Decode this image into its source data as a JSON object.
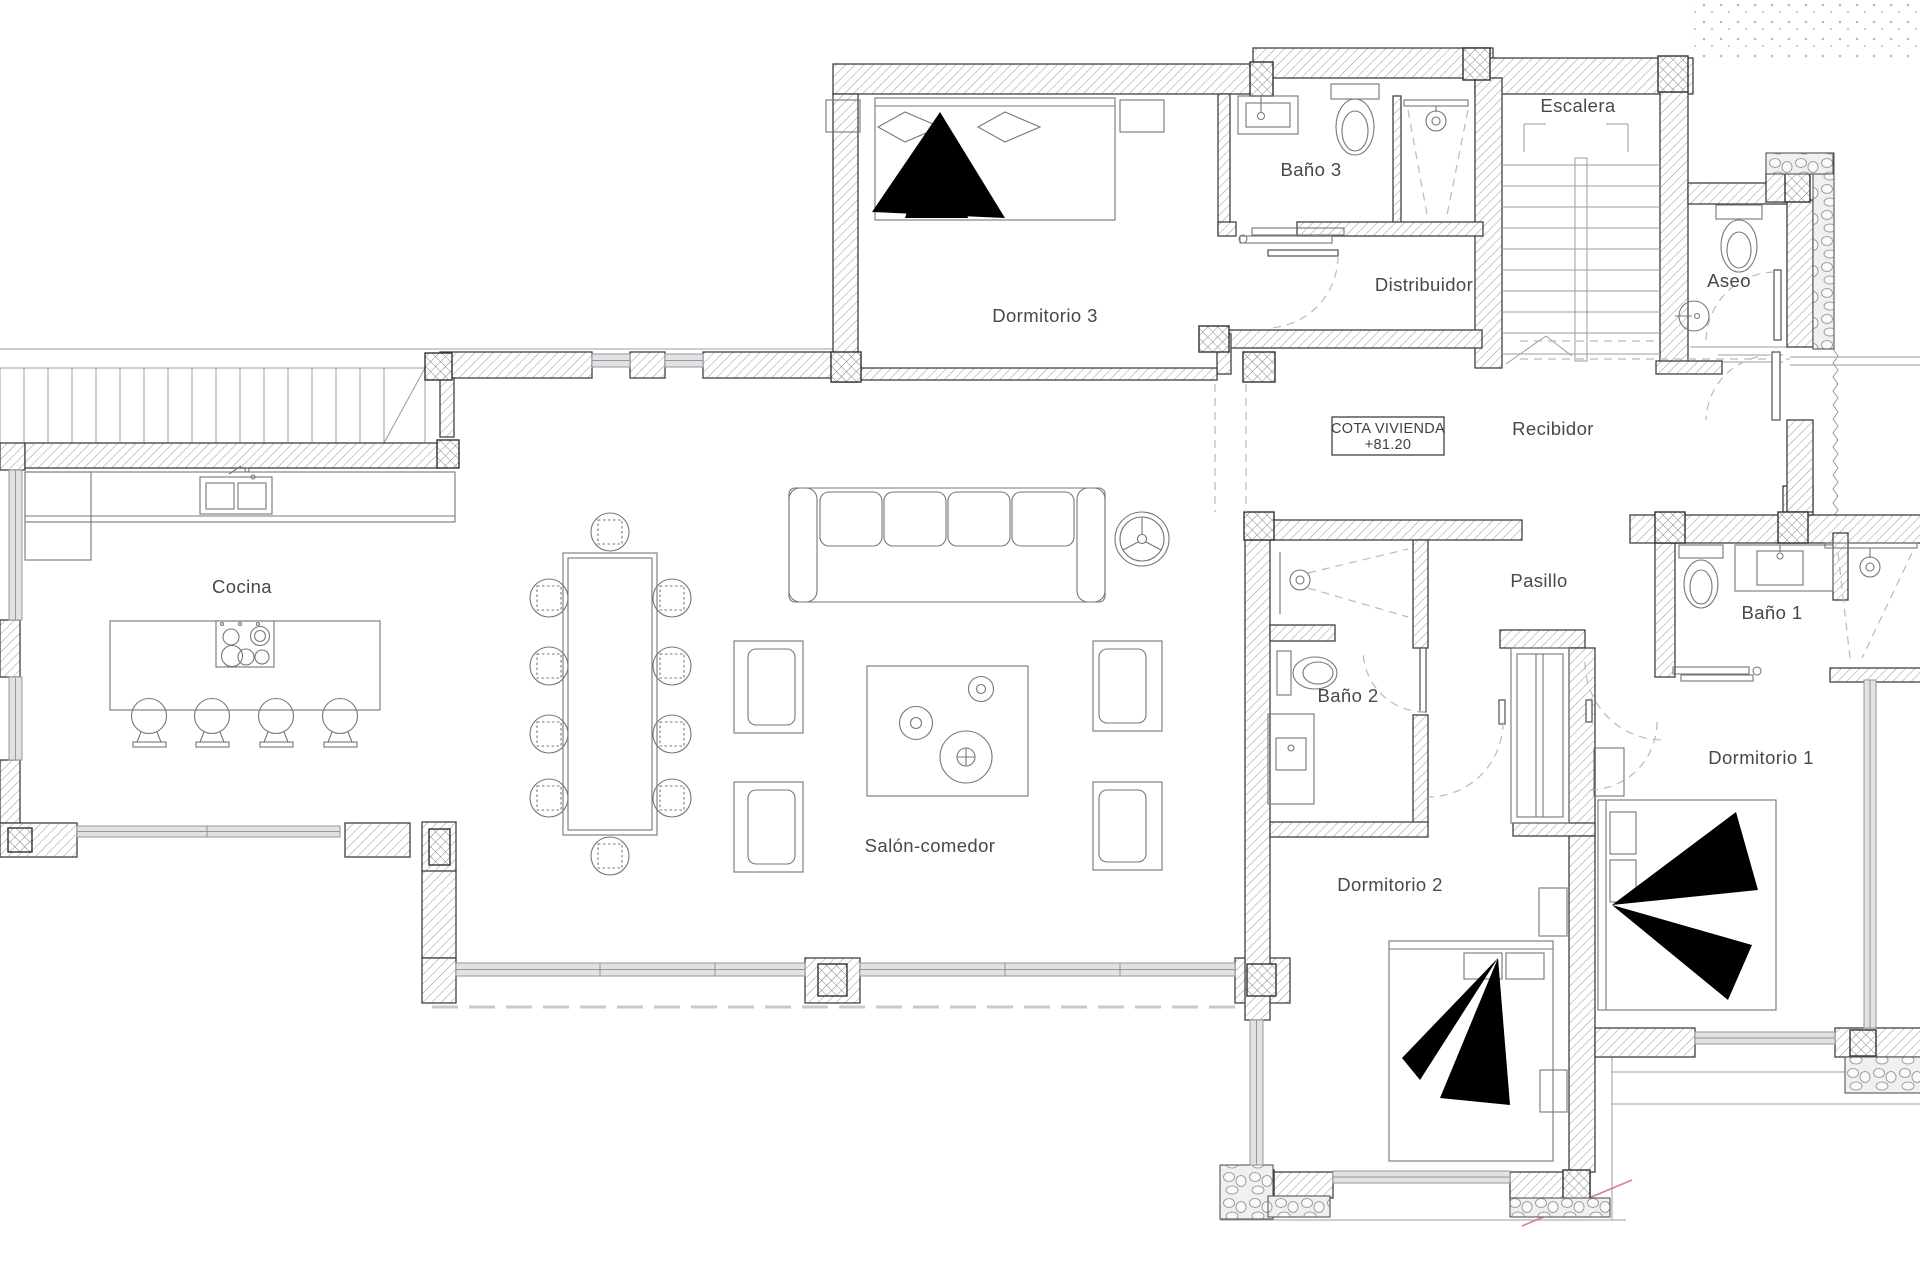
{
  "plan": {
    "title": "Planta vivienda",
    "rooms": [
      {
        "id": "cocina",
        "label": "Cocina"
      },
      {
        "id": "salon-comedor",
        "label": "Salón-comedor"
      },
      {
        "id": "dormitorio-3",
        "label": "Dormitorio 3"
      },
      {
        "id": "bano-3",
        "label": "Baño 3"
      },
      {
        "id": "distribuidor",
        "label": "Distribuidor"
      },
      {
        "id": "escalera",
        "label": "Escalera"
      },
      {
        "id": "aseo",
        "label": "Aseo"
      },
      {
        "id": "recibidor",
        "label": "Recibidor"
      },
      {
        "id": "pasillo",
        "label": "Pasillo"
      },
      {
        "id": "bano-1",
        "label": "Baño 1"
      },
      {
        "id": "bano-2",
        "label": "Baño 2"
      },
      {
        "id": "dormitorio-1",
        "label": "Dormitorio 1"
      },
      {
        "id": "dormitorio-2",
        "label": "Dormitorio 2"
      }
    ],
    "cota_box": {
      "line1": "COTA VIVIENDA",
      "line2": "+81.20"
    },
    "colors": {
      "wall_line": "#3f4045",
      "hatch": "#97989b",
      "label": "#46484c",
      "glass": "#96979b",
      "dashed": "#b9babd",
      "accent_red": "#d46a74"
    }
  }
}
